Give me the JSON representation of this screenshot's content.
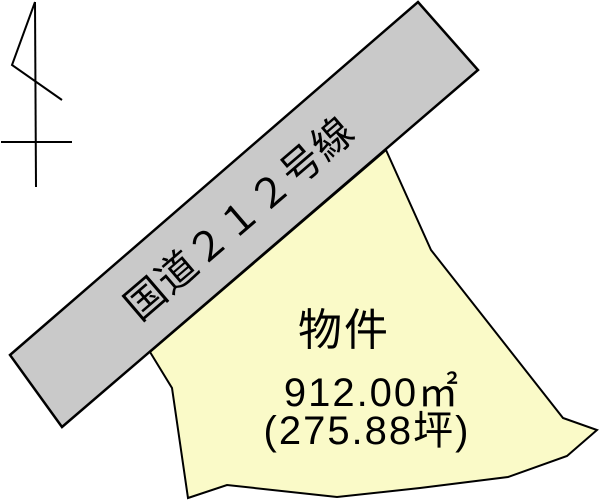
{
  "diagram": {
    "kind": "land-parcel-location-sketch",
    "colors": {
      "background": "#ffffff",
      "road_fill": "#c9c9c9",
      "parcel_fill": "#fafac8",
      "line": "#000000"
    },
    "road": {
      "label": "国道２１２号線"
    },
    "parcel": {
      "label": "物件",
      "area_label": "912.00㎡",
      "tsubo_label": "(275.88坪)"
    },
    "north_arrow": {
      "meaning": "north-direction-symbol"
    }
  }
}
